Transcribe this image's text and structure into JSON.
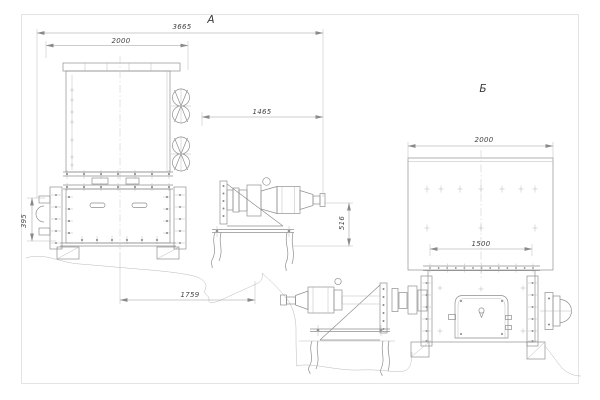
{
  "drawing": {
    "views": {
      "a": {
        "label": "А",
        "dimensions": {
          "overall_width": "3665",
          "hopper_width": "2000",
          "drive_offset": "1465",
          "side_height": "395",
          "base_length": "1759",
          "drive_axis_height": "516"
        }
      },
      "b": {
        "label": "Б",
        "dimensions": {
          "hopper_width": "2000",
          "flange_span": "1500"
        }
      }
    },
    "colors": {
      "main_line": "#8f8f8f",
      "thin_line": "#b9b9b9",
      "frame": "#d2d2d2",
      "text": "#454545",
      "background": "#ffffff"
    }
  }
}
